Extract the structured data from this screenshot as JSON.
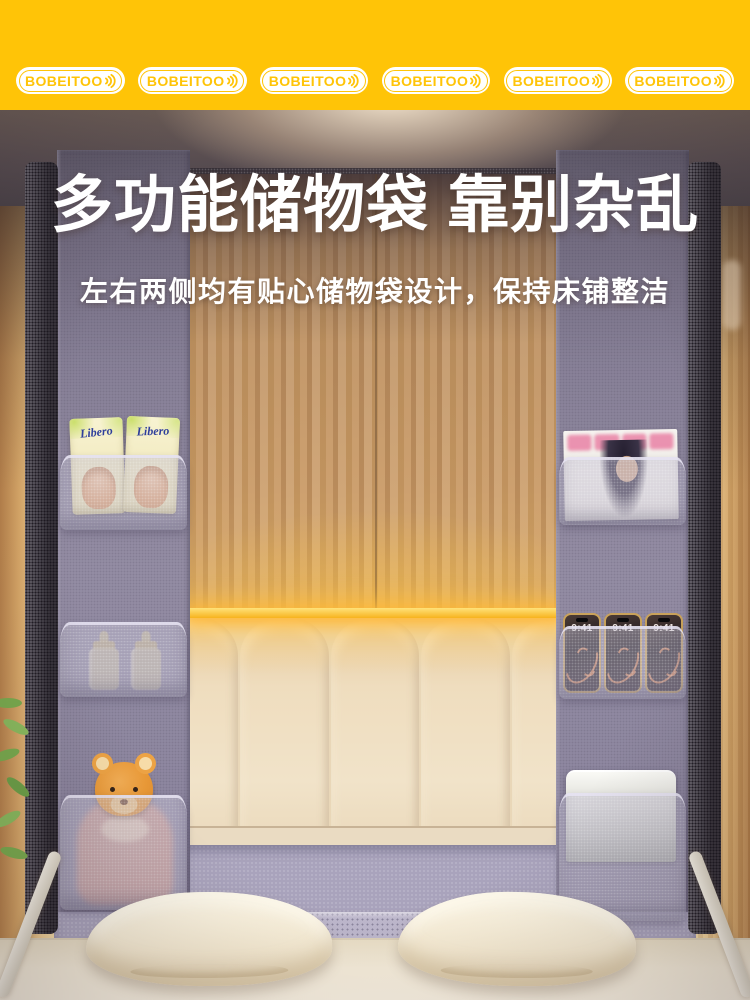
{
  "banner": {
    "badges": [
      "BOBEITOO",
      "BOBEITOO",
      "BOBEITOO",
      "BOBEITOO",
      "BOBEITOO",
      "BOBEITOO"
    ],
    "background_color": "#FFC407",
    "badge_fill": "#FFFFFF",
    "badge_text_color": "#FFC407"
  },
  "hero": {
    "title": "多功能储物袋 靠别杂乱",
    "subtitle": "左右两侧均有贴心储物袋设计，保持床铺整洁",
    "text_color": "#FFFFFF"
  },
  "scene": {
    "left_pockets": {
      "diaper_brand_label": "Libero"
    },
    "right_pockets": {
      "phone_lock_screen_time": "9:41"
    },
    "colors": {
      "storage_panel": "#8C8599",
      "pocket_mesh": "#C6C1D5",
      "curtain": "#C79B6F",
      "headboard": "#EFDDBE",
      "led_strip": "#FFC83C",
      "mattress": "#F3E9D6",
      "pillow": "#F7EFDC",
      "frame_pole": "#4D4853",
      "teddy_bear": "#E99937",
      "wall_glow": "#EFCE96"
    }
  }
}
